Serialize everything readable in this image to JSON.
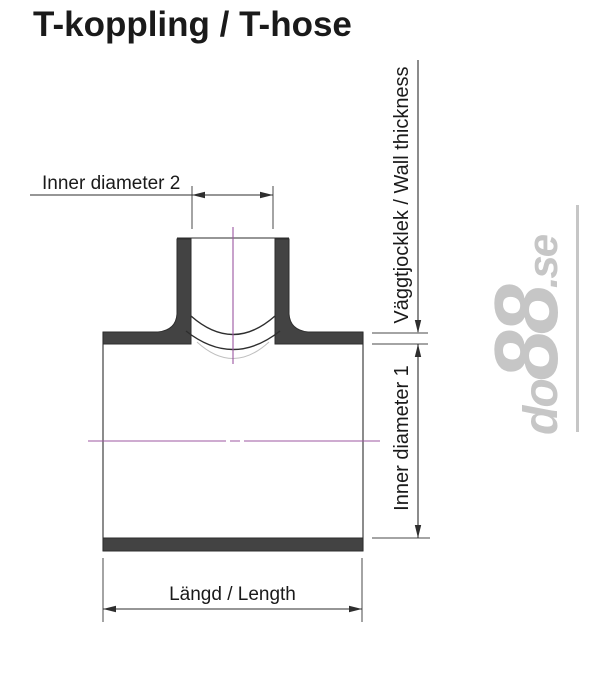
{
  "title": "T-koppling / T-hose",
  "labels": {
    "inner_diameter_2": "Inner diameter 2",
    "wall_thickness": "Väggtjocklek / Wall thickness",
    "inner_diameter_1": "Inner diameter 1",
    "length": "Längd / Length"
  },
  "watermark": {
    "prefix": "do",
    "number": "88",
    "suffix": ".se"
  },
  "colors": {
    "background": "#ffffff",
    "text": "#1a1a1a",
    "line": "#2e2e2e",
    "ext_line": "#4a4a4a",
    "wall_fill": "#434343",
    "centerline": "#9c57a1",
    "watermark": "#c6c6c6"
  }
}
